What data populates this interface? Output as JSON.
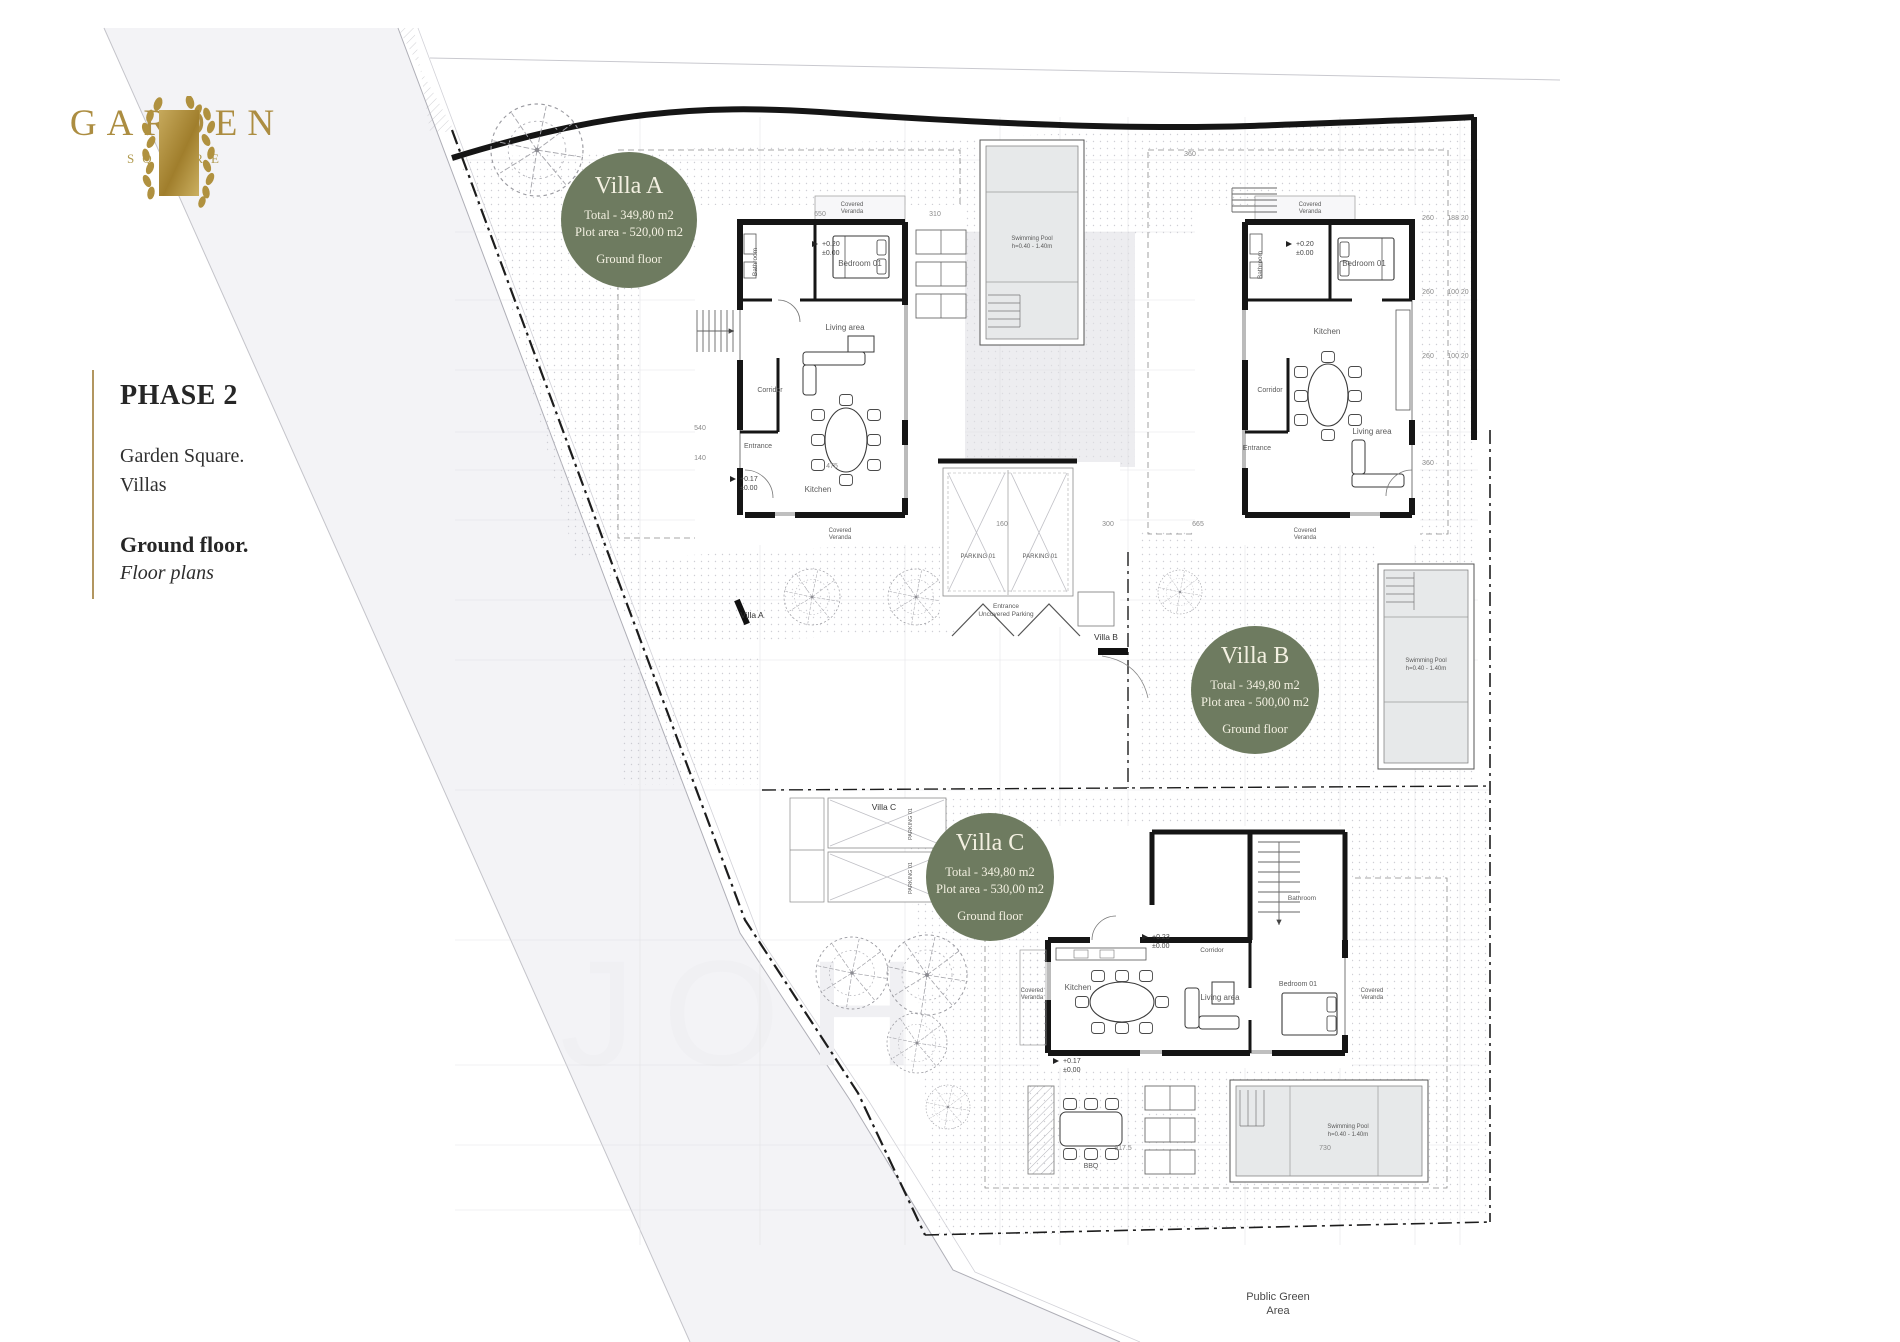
{
  "brand": {
    "name": "GARDEN",
    "sub": "SQUARE"
  },
  "sidebar": {
    "phase": "PHASE 2",
    "project_line1": "Garden Square.",
    "project_line2": "Villas",
    "floor": "Ground floor.",
    "subtitle": "Floor plans"
  },
  "badges": [
    {
      "title": "Villa A",
      "total": "Total - 349,80 m2",
      "plot": "Plot area - 520,00 m2",
      "floor": "Ground floor"
    },
    {
      "title": "Villa B",
      "total": "Total - 349,80 m2",
      "plot": "Plot area - 500,00 m2",
      "floor": "Ground floor"
    },
    {
      "title": "Villa C",
      "total": "Total - 349,80 m2",
      "plot": "Plot area - 530,00 m2",
      "floor": "Ground floor"
    }
  ],
  "plan": {
    "villa_a": {
      "bedroom": "Bedroom 01",
      "bathroom": "Bathroom",
      "living": "Living area",
      "corridor": "Corridor",
      "entrance": "Entrance",
      "kitchen": "Kitchen"
    },
    "villa_b": {
      "bedroom": "Bedroom 01",
      "bathroom": "Bathroom",
      "living": "Living area",
      "corridor": "Corridor",
      "entrance": "Entrance",
      "kitchen": "Kitchen"
    },
    "villa_c": {
      "bedroom": "Bedroom 01",
      "bathroom": "Bathroom",
      "living": "Living area",
      "corridor": "Corridor",
      "kitchen": "Kitchen",
      "bbq": "BBQ"
    },
    "veranda_word1": "Covered",
    "veranda_word2": "Veranda",
    "pool": {
      "l1": "Swimming Pool",
      "l2": "h=0.40 - 1.40m"
    },
    "parking": {
      "stall": "PARKING 01",
      "e1": "Entrance",
      "e2": "Uncovered Parking"
    },
    "gates": {
      "a": "Villa A",
      "b": "Villa B",
      "c": "Villa C"
    },
    "levels": {
      "entry": "+0.17",
      "zero": "±0.00",
      "veranda": "+0.20",
      "c_top": "+0.23"
    },
    "dims": [
      "650",
      "310",
      "360",
      "260",
      "188  20",
      "100  20",
      "665",
      "160",
      "300",
      "475",
      "917.5",
      "730",
      "360",
      "540",
      "140"
    ],
    "public_green": {
      "l1": "Public Green",
      "l2": "Area"
    },
    "watermark": "JOH"
  },
  "colors": {
    "badge_green": "#6e7b60",
    "gold": "#ac8d41",
    "wall": "#151515"
  }
}
